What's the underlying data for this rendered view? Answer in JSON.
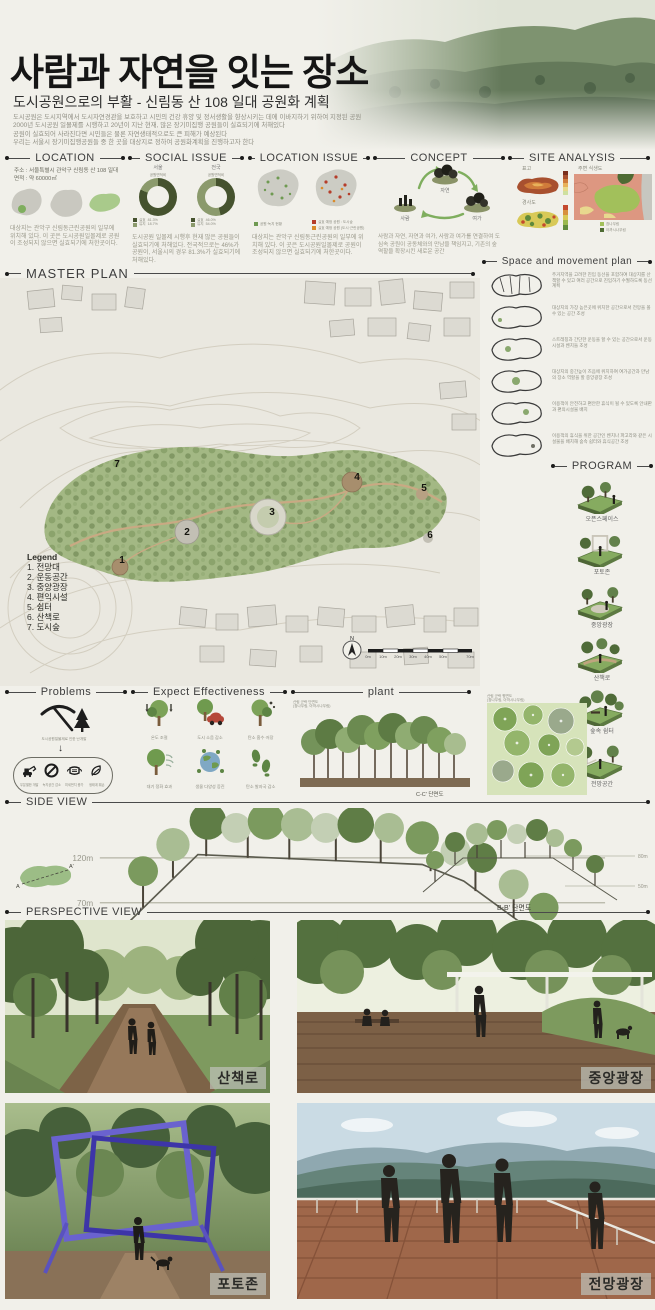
{
  "header": {
    "title": "사람과 자연을 잇는 장소",
    "subtitle": "도시공원으로의 부활 - 신림동 산 108 일대 공원화 계획",
    "intro_lines": [
      "도시공원은 도시지역에서 도시자연경관을 보호하고 시민의 건강 휴양 및 정서생활을 향상시키는 데에 이바지하기 위하여 지정된 공원",
      "2000년 도시공원 일몰제를 시행하고 20년이 지난 현재, 많은 장기미집행 공원들이 실효되기에 처해있다",
      "공원이 실효되어 사라진다면 시민들은 물론 자연생태적으로도 큰 피해가 예상된다",
      "우리는 서울시 장기미집행공원들 중 한 곳을 대상지로 정하여 공원화계획을 진행하고자 한다"
    ]
  },
  "location": {
    "title": "LOCATION",
    "address": "주소 : 서울특별시 관악구 신림동 산 108 일대",
    "area": "면적 : 약 60000㎡",
    "caption": "대상지는 관악구 신림동근린공원의 일부에 위치해 있다. 이 곳은 도시공원일몰제로 공원이 조성되지 않으면 실효되기에 처한곳이다."
  },
  "social_issue": {
    "title": "SOCIAL ISSUE",
    "charts": [
      {
        "region": "서울",
        "metric": "공원면적비",
        "legend": [
          {
            "name": "실효",
            "pct": "81.3%"
          },
          {
            "name": "유지",
            "pct": "18.7%"
          }
        ]
      },
      {
        "region": "전국",
        "metric": "공원면적비",
        "legend": [
          {
            "name": "실효",
            "pct": "46.0%"
          },
          {
            "name": "유지",
            "pct": "54.0%"
          }
        ]
      }
    ],
    "caption": "도시공원 일몰제 시행후 현재 많은 공원들이 실효되기에 처해있다. 전국적으로는 46%가 공원이, 서울시의 경우 81.3%가 실효되기에 처해있다."
  },
  "location_issue": {
    "title": "LOCATION ISSUE",
    "map1_legend": "공원·녹지 현황",
    "map2_legend1": "실효 예정 공원 : 도시숲",
    "map2_legend2": "실효 예정 공원 (도시·근린공원)",
    "caption": "대상지는 관악구 신림동근린공원의 일부에 위치해 있다. 이 곳은 도시공원일몰제로 공원이 조성되지 않으면 실효되기에 처한곳이다."
  },
  "concept": {
    "title": "CONCEPT",
    "node_top": "자연",
    "node_left": "사람",
    "node_right": "여가",
    "caption": "사람과 자연, 자연과 여가, 사람과 여가를 연결하여 도심속 공원이 공동체와의 만남을 책임지고, 기존의 숲 역할을 확장시킨 새로운 공간"
  },
  "site_analysis": {
    "title": "SITE ANALYSIS",
    "item1": "표고",
    "item2": "경사도",
    "item3": "주변 식생도",
    "legend1": "참나무림",
    "legend2": "아까시나무림"
  },
  "master_plan": {
    "title": "MASTER PLAN",
    "legend_title": "Legend",
    "legend": [
      {
        "num": "1",
        "label": "전망대"
      },
      {
        "num": "2",
        "label": "운동공간"
      },
      {
        "num": "3",
        "label": "중앙광장"
      },
      {
        "num": "4",
        "label": "편익시설"
      },
      {
        "num": "5",
        "label": "쉼터"
      },
      {
        "num": "6",
        "label": "산책로"
      },
      {
        "num": "7",
        "label": "도시숲"
      }
    ],
    "compass_n": "N",
    "scale_labels": [
      "0m",
      "10m",
      "20m",
      "30m",
      "40m",
      "50m",
      "70m"
    ]
  },
  "movement_plan": {
    "title": "Space and movement plan",
    "items": [
      "주거지역을 고려한 진입 동선을 포함하여 대상지를 산책할 수 있고 여러 공간으로 진입하기 수월하도록 동선 계획",
      "대상지의 가장 높은곳에 위치한 공간으로서 전망을 볼 수 있는 공간 조성",
      "스트레칭과 간단한 운동을 할 수 있는 공간으로서 운동시설과 벤치들 조성",
      "대상지의 중간높이 즈음에 위치하여 여가공간과 만남의 장소 역할을 할 중앙광장 조성",
      "이용객이 안전하고 편안한 휴식이 될 수 있도록 안내판과 편의시설물 배치",
      "이용객의 휴식을 위한 공간인 벤치나 파고라와 같은 시설물을 배치해 숲속 쉼터와 휴식공간 조성"
    ]
  },
  "program": {
    "title": "PROGRAM",
    "items": [
      "오픈스페이스",
      "포토존",
      "중앙광장",
      "산책로",
      "숲속 쉼터",
      "전망공간"
    ]
  },
  "problems": {
    "title": "Problems",
    "cause": "도시공원일몰제로 인한 난개발",
    "effects": [
      "무분별한 개발",
      "녹지공간 감소",
      "미세먼지 증가",
      "생태계 훼손"
    ]
  },
  "effectiveness": {
    "title": "Expect Effectiveness",
    "items": [
      "온도 조절",
      "도시 소음 감소",
      "탄소 흡수·저장",
      "대기 정화 효과",
      "생물 다양성 증진",
      "탄소 발자국 감소"
    ]
  },
  "plant": {
    "title": "plant",
    "section_note1": "산림 군락 단면도",
    "section_note2": "(참나무림, 아까시나무림)",
    "plan_note1": "산림 군락 평면도",
    "plan_note2": "(참나무림, 아까시나무림)",
    "section_label": "C-C' 단면도"
  },
  "side_view": {
    "title": "SIDE VIEW",
    "a_label": "A-A' 단면도",
    "b_label": "B-B' 단면도",
    "a_elev_top": "120m",
    "a_elev_bottom": "70m",
    "b_elev_top": "80m",
    "b_elev_bottom": "50m",
    "inset_a": "A",
    "inset_a2": "A'"
  },
  "perspective": {
    "title": "PERSPECTIVE VIEW",
    "img1": "산책로",
    "img2": "중앙광장",
    "img3": "포토존",
    "img4": "전망광장"
  }
}
